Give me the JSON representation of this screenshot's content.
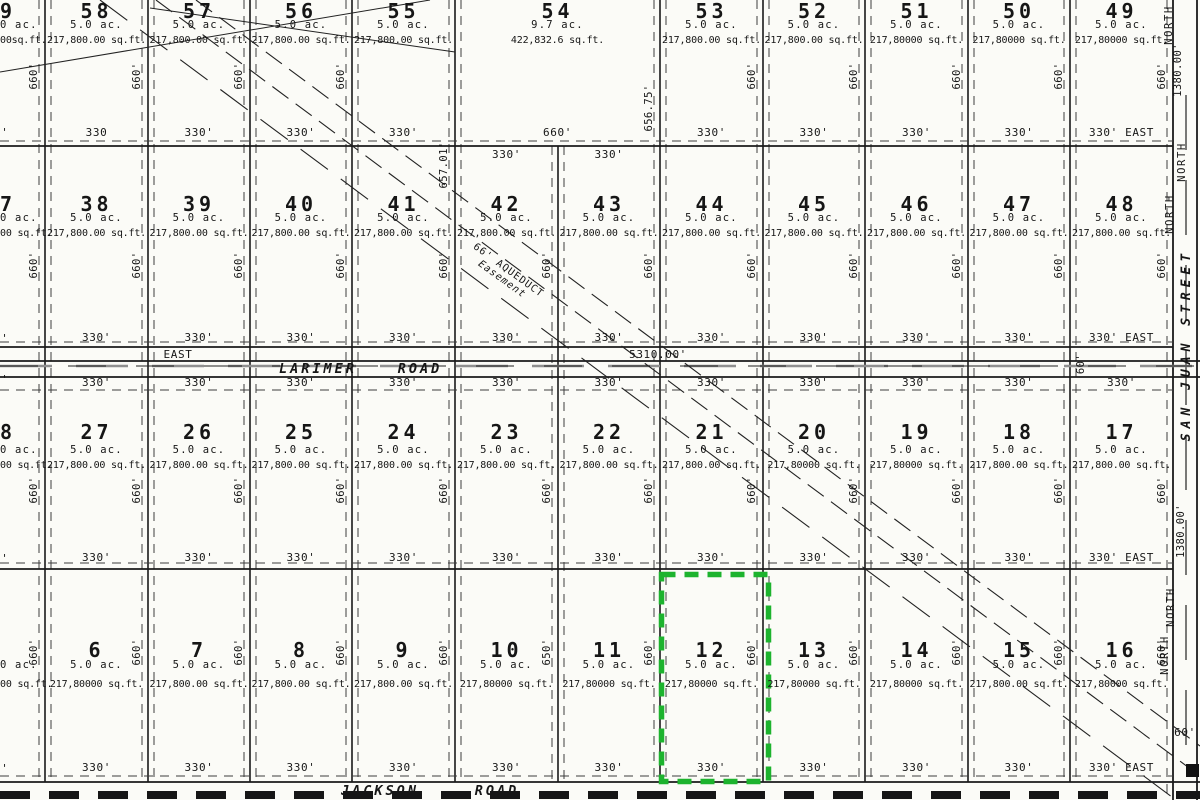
{
  "misc": {
    "stub": "0'"
  },
  "highlight": {
    "lot": "12",
    "color": "#1db32e"
  },
  "easement": {
    "line1": "66' AQUEDUCT",
    "line2": "Easement"
  },
  "roads": {
    "larimer": {
      "east": "EAST",
      "name": "LARIMER",
      "type": "ROAD",
      "length": "5310.00'",
      "width": "60'"
    },
    "jackson": {
      "name": "JACKSON",
      "type": "ROAD",
      "width": "60'"
    }
  },
  "street": {
    "name": "SAN JUAN STREET",
    "north": "NORTH",
    "dim_top": "1380.00'",
    "dim_mid": "1380.00'"
  },
  "grid": {
    "rows": [
      {
        "lots": [
          {
            "number": "9",
            "acres": "0 ac.",
            "sqft": "00sq.ft.",
            "side": "660'"
          },
          {
            "number": "58",
            "acres": "5.0 ac.",
            "sqft": "217,800.00 sq.ft.",
            "side": "660'",
            "bottom": "330"
          },
          {
            "number": "57",
            "acres": "5.0 ac.",
            "sqft": "217,800.00 sq.ft.",
            "side": "660'",
            "bottom": "330'"
          },
          {
            "number": "56",
            "acres": "5.0 ac.",
            "sqft": "217,800.00 sq.ft.",
            "side": "660'",
            "bottom": "330'"
          },
          {
            "number": "55",
            "acres": "5.0 ac.",
            "sqft": "217,800.00 sq.ft.",
            "side": "657.01'",
            "bottom": "330'"
          },
          {
            "number": "54",
            "acres": "9.7 ac.",
            "sqft": "422,832.6 sq.ft.",
            "side": "656.75'",
            "bottom": "660'",
            "wide": true
          },
          {
            "number": "53",
            "acres": "5.0 ac.",
            "sqft": "217,800.00 sq.ft.",
            "side": "660'",
            "bottom": "330'"
          },
          {
            "number": "52",
            "acres": "5.0 ac.",
            "sqft": "217,800.00 sq.ft.",
            "side": "660'",
            "bottom": "330'"
          },
          {
            "number": "51",
            "acres": "5.0 ac.",
            "sqft": "217,80000 sq.ft.",
            "side": "660'",
            "bottom": "330'"
          },
          {
            "number": "50",
            "acres": "5.0 ac.",
            "sqft": "217,80000 sq.ft.",
            "side": "660'",
            "bottom": "330'"
          },
          {
            "number": "49",
            "acres": "5.0 ac.",
            "sqft": "217,80000 sq.ft.",
            "side": "660'",
            "bottom": "330' EAST"
          }
        ]
      },
      {
        "lots": [
          {
            "number": "7",
            "acres": "0 ac.",
            "sqft": "00 sq.ft.",
            "side": "660'"
          },
          {
            "number": "38",
            "acres": "5.0 ac.",
            "sqft": "217,800.00 sq.ft.",
            "side": "660'",
            "bottom": "330'"
          },
          {
            "number": "39",
            "acres": "5.0 ac.",
            "sqft": "217,800.00 sq.ft.",
            "side": "660'",
            "bottom": "330'"
          },
          {
            "number": "40",
            "acres": "5.0 ac.",
            "sqft": "217,800.00 sq.ft.",
            "side": "660'",
            "bottom": "330'"
          },
          {
            "number": "41",
            "acres": "5.0 ac.",
            "sqft": "217,800.00 sq.ft.",
            "side": "660'",
            "bottom": "330'"
          },
          {
            "number": "42",
            "acres": "5.0 ac.",
            "sqft": "217,800.00 sq.ft.",
            "side": "660'",
            "bottom": "330'",
            "top": "330'"
          },
          {
            "number": "43",
            "acres": "5.0 ac.",
            "sqft": "217,800.00 sq.ft.",
            "side": "660'",
            "bottom": "330'",
            "top": "330'"
          },
          {
            "number": "44",
            "acres": "5.0 ac.",
            "sqft": "217,800.00 sq.ft.",
            "side": "660'",
            "bottom": "330'"
          },
          {
            "number": "45",
            "acres": "5.0 ac.",
            "sqft": "217,800.00 sq.ft.",
            "side": "660'",
            "bottom": "330'"
          },
          {
            "number": "46",
            "acres": "5.0 ac.",
            "sqft": "217,800.00 sq.ft.",
            "side": "660'",
            "bottom": "330'"
          },
          {
            "number": "47",
            "acres": "5.0 ac.",
            "sqft": "217,800.00 sq.ft.",
            "side": "660'",
            "bottom": "330'"
          },
          {
            "number": "48",
            "acres": "5.0 ac.",
            "sqft": "217,800.00 sq.ft.",
            "side": "660'",
            "bottom": "330' EAST"
          }
        ]
      },
      {
        "lots": [
          {
            "number": "8",
            "acres": "0 ac.",
            "sqft": "00 sq.ft.",
            "side": "660'"
          },
          {
            "number": "27",
            "acres": "5.0 ac.",
            "sqft": "217,800.00 sq.ft.",
            "side": "660'",
            "bottom": "330'",
            "top": "330'"
          },
          {
            "number": "26",
            "acres": "5.0 ac.",
            "sqft": "217,800.00 sq.ft.",
            "side": "660'",
            "bottom": "330'",
            "top": "330'"
          },
          {
            "number": "25",
            "acres": "5.0 ac.",
            "sqft": "217,800.00 sq.ft.",
            "side": "660'",
            "bottom": "330'",
            "top": "330'"
          },
          {
            "number": "24",
            "acres": "5.0 ac.",
            "sqft": "217,800.00 sq.ft.",
            "side": "660'",
            "bottom": "330'",
            "top": "330'"
          },
          {
            "number": "23",
            "acres": "5.0 ac.",
            "sqft": "217,800.00 sq.ft.",
            "side": "660'",
            "bottom": "330'",
            "top": "330'"
          },
          {
            "number": "22",
            "acres": "5.0 ac.",
            "sqft": "217,800.00 sq.ft.",
            "side": "660'",
            "bottom": "330'",
            "top": "330'"
          },
          {
            "number": "21",
            "acres": "5.0 ac.",
            "sqft": "217,800.00 sq.ft.",
            "side": "660'",
            "bottom": "330'",
            "top": "330'"
          },
          {
            "number": "20",
            "acres": "5.0 ac.",
            "sqft": "217,80000 sq.ft.",
            "side": "660'",
            "bottom": "330'",
            "top": "330'"
          },
          {
            "number": "19",
            "acres": "5.0 ac.",
            "sqft": "217,80000 sq.ft.",
            "side": "660'",
            "bottom": "330'",
            "top": "330'"
          },
          {
            "number": "18",
            "acres": "5.0 ac.",
            "sqft": "217,800.00 sq.ft.",
            "side": "660'",
            "bottom": "330'",
            "top": "330'"
          },
          {
            "number": "17",
            "acres": "5.0 ac.",
            "sqft": "217,800.00 sq.ft.",
            "side": "660'",
            "bottom": "330' EAST",
            "top": "330'"
          }
        ]
      },
      {
        "lots": [
          {
            "number": "",
            "acres": "0 ac.",
            "sqft": "00 sq.ft.",
            "side": "660'"
          },
          {
            "number": "6",
            "acres": "5.0 ac.",
            "sqft": "217,80000 sq.ft.",
            "side": "660'",
            "bottom": "330'"
          },
          {
            "number": "7",
            "acres": "5.0 ac.",
            "sqft": "217,800.00 sq.ft.",
            "side": "660'",
            "bottom": "330'"
          },
          {
            "number": "8",
            "acres": "5.0 ac.",
            "sqft": "217,800.00 sq.ft.",
            "side": "660'",
            "bottom": "330'"
          },
          {
            "number": "9",
            "acres": "5.0 ac.",
            "sqft": "217,800.00 sq.ft.",
            "side": "660'",
            "bottom": "330'"
          },
          {
            "number": "10",
            "acres": "5.0 ac.",
            "sqft": "217,80000 sq.ft.",
            "side": "650'",
            "bottom": "330'"
          },
          {
            "number": "11",
            "acres": "5.0 ac.",
            "sqft": "217,80000 sq.ft.",
            "side": "660'",
            "bottom": "330'"
          },
          {
            "number": "12",
            "acres": "5.0 ac.",
            "sqft": "217,80000 sq.ft.",
            "side": "660'",
            "bottom": "330'"
          },
          {
            "number": "13",
            "acres": "5.0 ac.",
            "sqft": "217,80000 sq.ft.",
            "side": "660'",
            "bottom": "330'"
          },
          {
            "number": "14",
            "acres": "5.0 ac.",
            "sqft": "217,80000 sq.ft.",
            "side": "660'",
            "bottom": "330'"
          },
          {
            "number": "15",
            "acres": "5.0 ac.",
            "sqft": "217,800.00 sq.ft.",
            "side": "660'",
            "bottom": "330'"
          },
          {
            "number": "16",
            "acres": "5.0 ac.",
            "sqft": "217,80000 sq.ft.",
            "side": "660'",
            "bottom": "330' EAST"
          }
        ]
      }
    ]
  }
}
